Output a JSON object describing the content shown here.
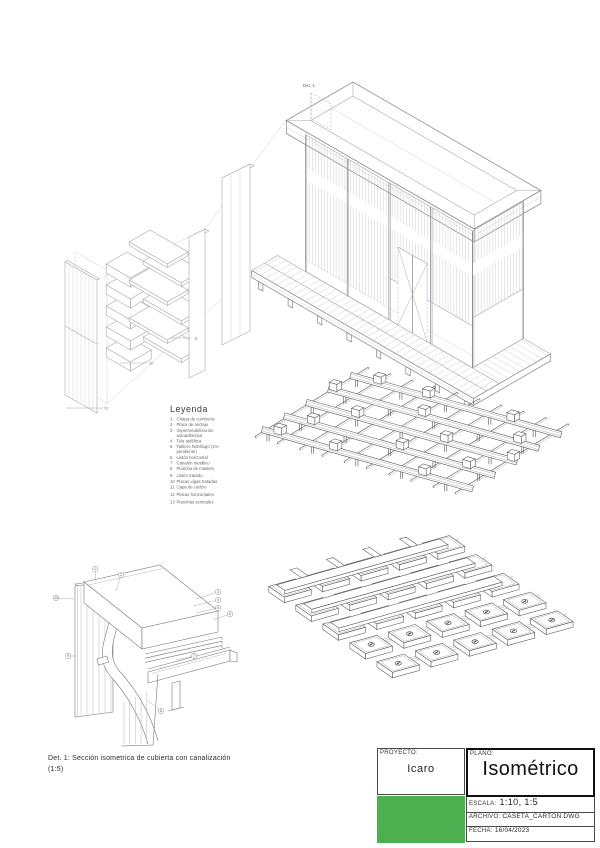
{
  "sheet": {
    "det1_label": "Det. 1",
    "caption_line1": "Det. 1: Sección isometrica de cubierta  con canalización",
    "caption_line2": "(1:5)",
    "detail_markers": [
      "1",
      "2",
      "3",
      "4",
      "5",
      "6",
      "7",
      "8",
      "9",
      "13"
    ],
    "panel_markers": [
      "11",
      "12",
      "13"
    ]
  },
  "legend": {
    "title": "Leyenda",
    "items": [
      {
        "num": "1",
        "label": "Chapa de cumbrera"
      },
      {
        "num": "2",
        "label": "Placa de anclaje"
      },
      {
        "num": "3",
        "label": "Impermeabilización autoadhesiva"
      },
      {
        "num": "4",
        "label": "Tela asfáltica"
      },
      {
        "num": "5",
        "label": "Tablero hidrófugo (1% pendiente)"
      },
      {
        "num": "6",
        "label": "Listón horizontal"
      },
      {
        "num": "7",
        "label": "Canalón metálico"
      },
      {
        "num": "8",
        "label": "Plancha de madera"
      },
      {
        "num": "9",
        "label": "Listón tratado"
      },
      {
        "num": "10",
        "label": "Placas vigas tratadas"
      },
      {
        "num": "11",
        "label": "Capa de cartón"
      },
      {
        "num": "12",
        "label": "Placas horizontales"
      },
      {
        "num": "13",
        "label": "Planchas verticales"
      }
    ]
  },
  "title_block": {
    "project_label": "PROYECTO:",
    "project_value": "Icaro",
    "plan_label": "PLANO:",
    "plan_value": "Isométrico",
    "scale_label": "ESCALA:",
    "scale_value": "1:10, 1:5",
    "file_label": "ARCHIVO:",
    "file_value": "CASETA_CARTON.DWG",
    "date_label": "FECHA:",
    "date_value": "16/04/2023",
    "logo_color": "#4caf50"
  }
}
